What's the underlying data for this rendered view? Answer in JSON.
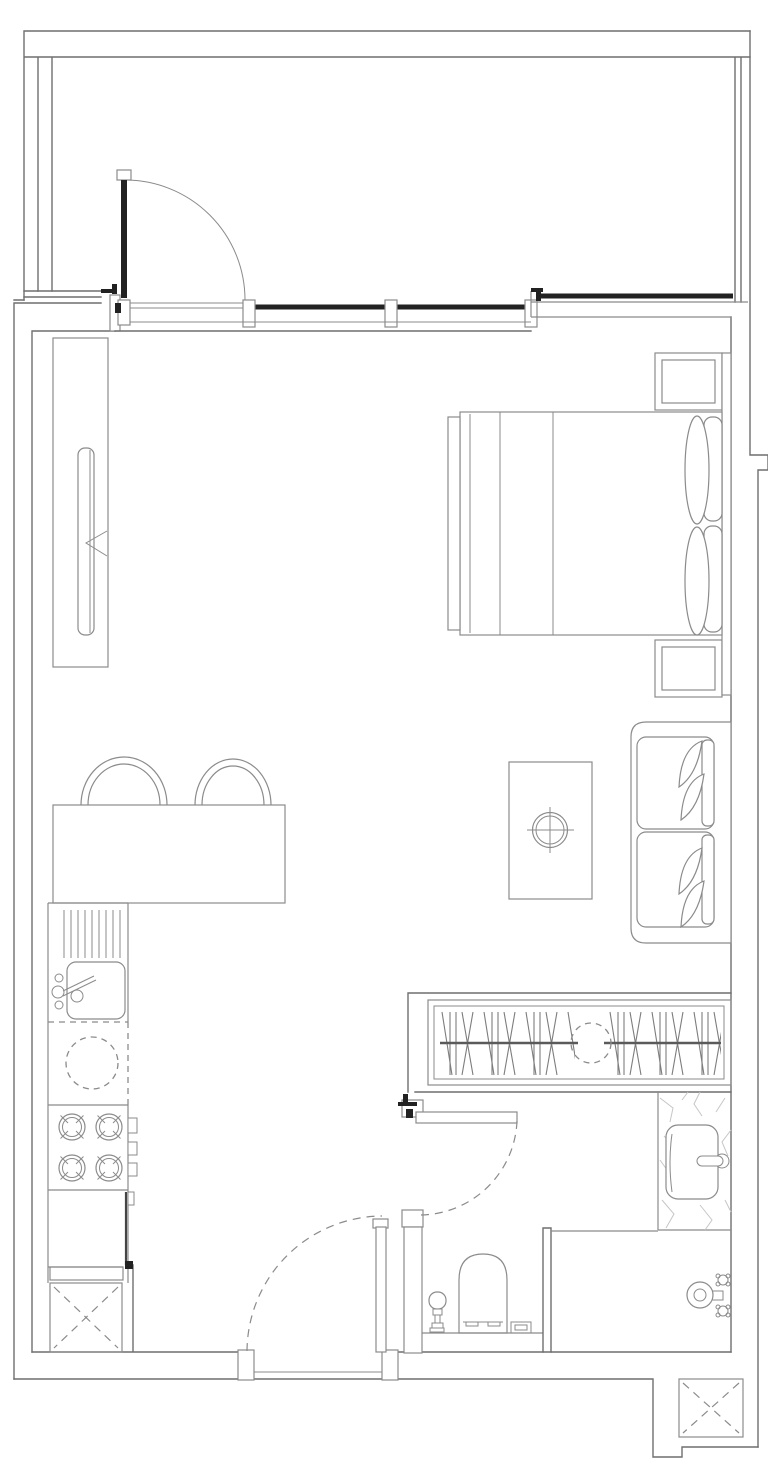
{
  "colors": {
    "wall": "#6f6f6f",
    "line": "#8b8b8b",
    "dark": "#222222",
    "hatch": "#7d7d7d",
    "marble": "#c6c6c6",
    "background": "#ffffff"
  },
  "plan": {
    "type": "floor-plan",
    "rooms": [
      "balcony",
      "living-dining",
      "bedroom-area",
      "kitchen",
      "hallway",
      "bathroom"
    ],
    "doors": [
      {
        "name": "balcony-door",
        "swing": "solid-arc"
      },
      {
        "name": "entry-door",
        "swing": "dashed-arc"
      },
      {
        "name": "bathroom-door",
        "swing": "dashed-arc"
      }
    ],
    "windows": [
      "living-window",
      "bedroom-window"
    ],
    "fixtures": [
      "tall-cabinet",
      "bar-counter",
      "bar-stool-left",
      "bar-stool-right",
      "drain-board",
      "kitchen-sink",
      "sink-faucet",
      "washing-machine",
      "cooktop-4-burner",
      "stove-knobs",
      "oven-cabinet",
      "kitchen-shaft",
      "double-bed",
      "pillow-upper",
      "pillow-lower",
      "headboard",
      "nightstand-top",
      "nightstand-bottom",
      "sofa-two-seat",
      "leaf-cushions",
      "coffee-table",
      "table-decor",
      "wardrobe-hanging-rail",
      "vanity-counter",
      "wash-basin",
      "basin-faucet",
      "toilet",
      "bidet-sprayer",
      "floor-drain",
      "shower-screen",
      "shower-mixer",
      "corner-shaft"
    ]
  }
}
